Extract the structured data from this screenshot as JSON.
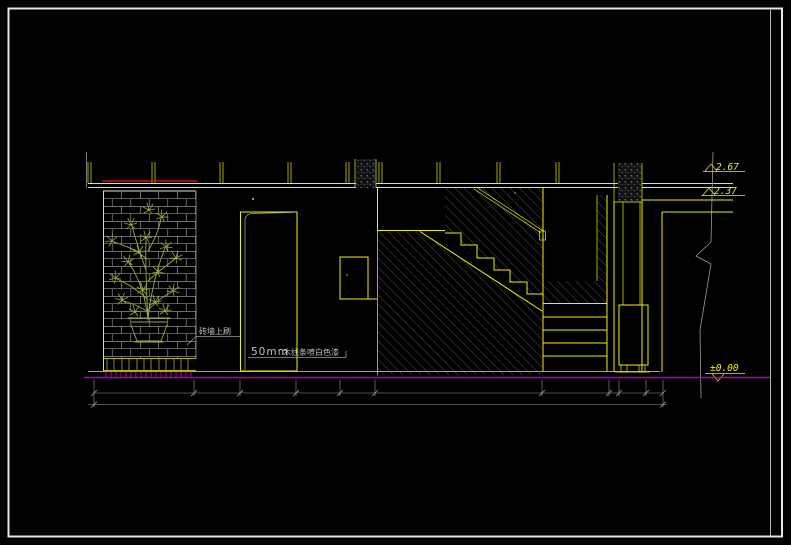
{
  "colors": {
    "background": "#000000",
    "frame": "#e6e6e6",
    "line_yellow": "#f0f000",
    "line_gray": "#9c9c9c",
    "brick_gray": "#8f8f8f",
    "hatch_gray": "#6f6f6f",
    "plant_green": "#8fae3c",
    "floor_magenta": "#b400b4",
    "accent_red": "#cd1111",
    "text_gray": "#c0c0c0"
  },
  "annotations": {
    "elevation_upper": "2.67",
    "elevation_mid": "2.37",
    "elevation_floor": "±0.00",
    "wall_note": "砖墙上刷",
    "trim_note_size": "50mm",
    "trim_note_text": "木线条喷白色漆"
  }
}
